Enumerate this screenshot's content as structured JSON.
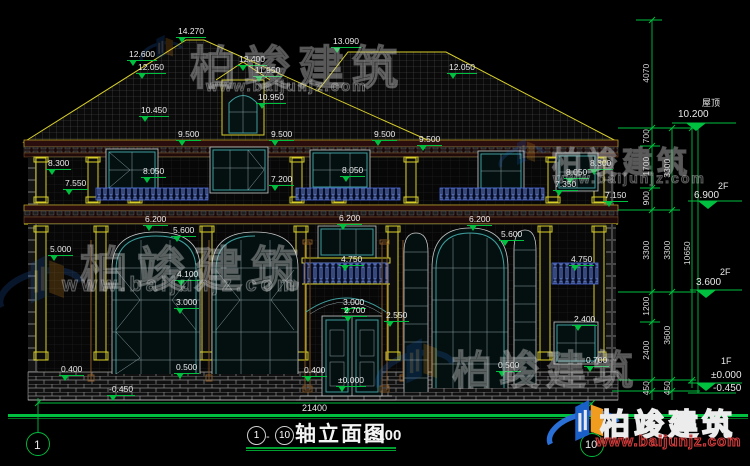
{
  "title": {
    "axis_from": "1",
    "axis_to": "10",
    "dash": "-",
    "name": "轴立面图",
    "scale": "1:100"
  },
  "brand": {
    "name": "柏竣建筑",
    "site": "www.baijunjz.com"
  },
  "axis_bubbles": {
    "left": "1",
    "right": "10"
  },
  "right_levels": [
    {
      "floor": "屋顶",
      "value": "10.200"
    },
    {
      "floor": "2F",
      "value": "6.900"
    },
    {
      "floor": "2F",
      "value": "3.600"
    },
    {
      "floor": "1F",
      "value": "±0.000"
    },
    {
      "floor": "",
      "value": "-0.450"
    }
  ],
  "dims": {
    "chain_a": [
      "4070",
      "700",
      "1700",
      "900",
      "3300",
      "1200",
      "2400",
      "450"
    ],
    "chain_b": [
      "3300",
      "3300",
      "3600",
      "450"
    ],
    "chain_c": [
      "10650"
    ],
    "total_width": "21400"
  },
  "elev": [
    "14.270",
    "12.600",
    "12.050",
    "10.450",
    "12.400",
    "11.950",
    "10.950",
    "13.090",
    "12.050",
    "9.500",
    "9.500",
    "9.500",
    "9.500",
    "8.300",
    "7.550",
    "8.050",
    "8.050",
    "7.200",
    "8.300",
    "8.050",
    "7.350",
    "7.150",
    "6.200",
    "6.200",
    "6.200",
    "5.600",
    "5.600",
    "5.000",
    "4.750",
    "4.750",
    "4.100",
    "3.000",
    "3.000",
    "2.700",
    "2.550",
    "2.400",
    "0.500",
    "0.500",
    "0.400",
    "0.400",
    "0.700",
    "±0.000",
    "-0.450"
  ]
}
